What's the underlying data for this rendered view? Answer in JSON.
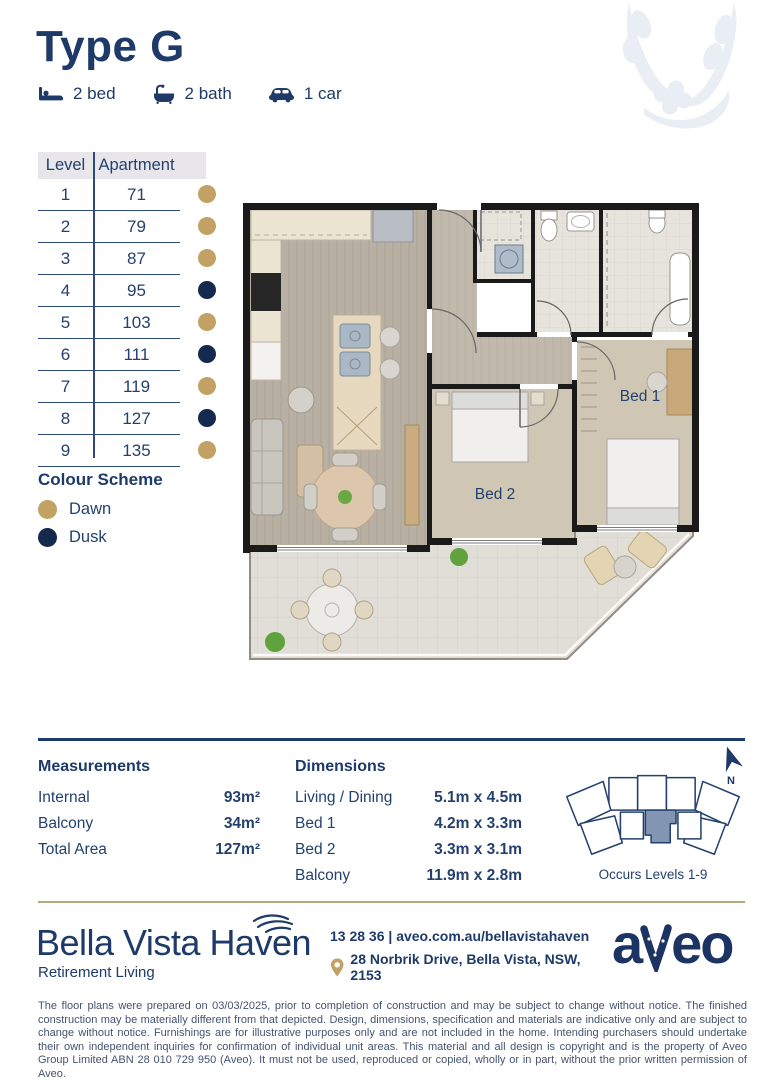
{
  "header": {
    "title": "Type G",
    "features": [
      {
        "icon": "bed-icon",
        "label": "2 bed"
      },
      {
        "icon": "bath-icon",
        "label": "2 bath"
      },
      {
        "icon": "car-icon",
        "label": "1 car"
      }
    ]
  },
  "apartment_table": {
    "columns": [
      "Level",
      "Apartment"
    ],
    "rows": [
      {
        "level": "1",
        "apartment": "71",
        "scheme": "dawn"
      },
      {
        "level": "2",
        "apartment": "79",
        "scheme": "dawn"
      },
      {
        "level": "3",
        "apartment": "87",
        "scheme": "dawn"
      },
      {
        "level": "4",
        "apartment": "95",
        "scheme": "dusk"
      },
      {
        "level": "5",
        "apartment": "103",
        "scheme": "dawn"
      },
      {
        "level": "6",
        "apartment": "111",
        "scheme": "dusk"
      },
      {
        "level": "7",
        "apartment": "119",
        "scheme": "dawn"
      },
      {
        "level": "8",
        "apartment": "127",
        "scheme": "dusk"
      },
      {
        "level": "9",
        "apartment": "135",
        "scheme": "dawn"
      }
    ]
  },
  "colour_scheme": {
    "title": "Colour Scheme",
    "items": [
      {
        "label": "Dawn",
        "color": "#c2a264"
      },
      {
        "label": "Dusk",
        "color": "#14294e"
      }
    ]
  },
  "floor_plan": {
    "bed1_label": "Bed 1",
    "bed2_label": "Bed 2"
  },
  "measurements": {
    "title": "Measurements",
    "rows": [
      {
        "label": "Internal",
        "value": "93m²"
      },
      {
        "label": "Balcony",
        "value": "34m²"
      },
      {
        "label": "Total Area",
        "value": "127m²"
      }
    ]
  },
  "dimensions": {
    "title": "Dimensions",
    "rows": [
      {
        "label": "Living / Dining",
        "value": "5.1m x 4.5m"
      },
      {
        "label": "Bed 1",
        "value": "4.2m x 3.3m"
      },
      {
        "label": "Bed 2",
        "value": "3.3m x 3.1m"
      },
      {
        "label": "Balcony",
        "value": "11.9m x 2.8m"
      }
    ]
  },
  "site_plan": {
    "caption": "Occurs Levels 1-9",
    "north_label": "N"
  },
  "footer": {
    "brand": "Bella Vista Haven",
    "tagline": "Retirement Living",
    "phone_line": "13 28 36 | aveo.com.au/bellavistahaven",
    "address": "28 Norbrik Drive, Bella Vista, NSW, 2153",
    "logo_a": "a",
    "logo_eo": "eo"
  },
  "disclaimer": "The floor plans were prepared on 03/03/2025, prior to completion of construction and may be subject to change without notice. The finished construction may be materially different from that depicted. Design, dimensions, specification and materials are indicative only and are subject to change without notice. Furnishings are for illustrative purposes only and are not included in the home. Intending purchasers should undertake their own independent inquiries for confirmation of individual unit areas. This material and all design is copyright and is the property of Aveo Group Limited ABN 28 010 729 950 (Aveo). It must not be used, reproduced or copied, wholly or in part, without the prior written permission of Aveo."
}
